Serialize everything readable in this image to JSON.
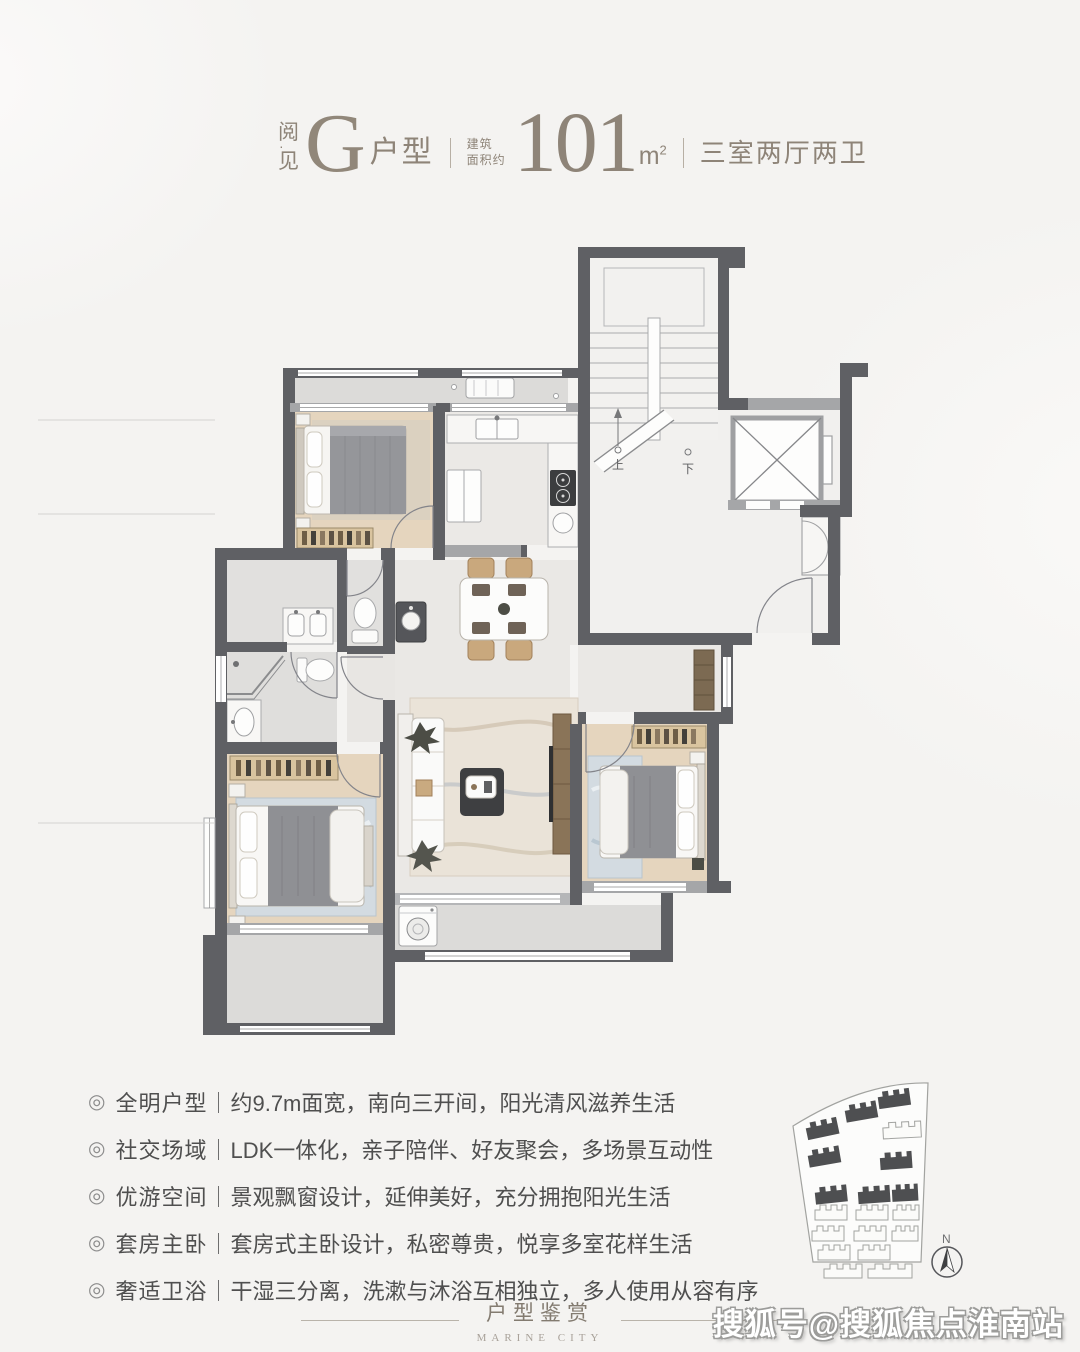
{
  "header": {
    "series": {
      "top": "阅",
      "dot": "·",
      "bottom": "见"
    },
    "unit_letter": "G",
    "unit_suffix": "户型",
    "area_label_line1": "建筑",
    "area_label_line2": "面积约",
    "area_value": "101",
    "area_unit_base": "m",
    "area_unit_sup": "2",
    "rooms_text": "三室两厅两卫"
  },
  "floorplan": {
    "stairs_up_label": "上",
    "stairs_down_label": "下"
  },
  "features": {
    "bullet": "◎",
    "items": [
      {
        "title": "全明户型",
        "desc": "约9.7m面宽，南向三开间，阳光清风滋养生活"
      },
      {
        "title": "社交场域",
        "desc": "LDK一体化，亲子陪伴、好友聚会，多场景互动性"
      },
      {
        "title": "优游空间",
        "desc": "景观飘窗设计，延伸美好，充分拥抱阳光生活"
      },
      {
        "title": "套房主卧",
        "desc": "套房式主卧设计，私密尊贵，悦享多室花样生活"
      },
      {
        "title": "奢适卫浴",
        "desc": "干湿三分离，洗漱与沐浴互相独立，多人使用从容有序"
      }
    ]
  },
  "sitemap": {
    "compass_label": "N"
  },
  "footer": {
    "title": "户型鉴赏",
    "subtitle": "MARINE CITY"
  },
  "watermark": {
    "text": "搜狐号@搜狐焦点淮南站"
  },
  "colors": {
    "accent": "#8e8478",
    "wall": "#5f6064",
    "wood_floor": "#e5d5be",
    "body_text": "#4f4f4f"
  }
}
